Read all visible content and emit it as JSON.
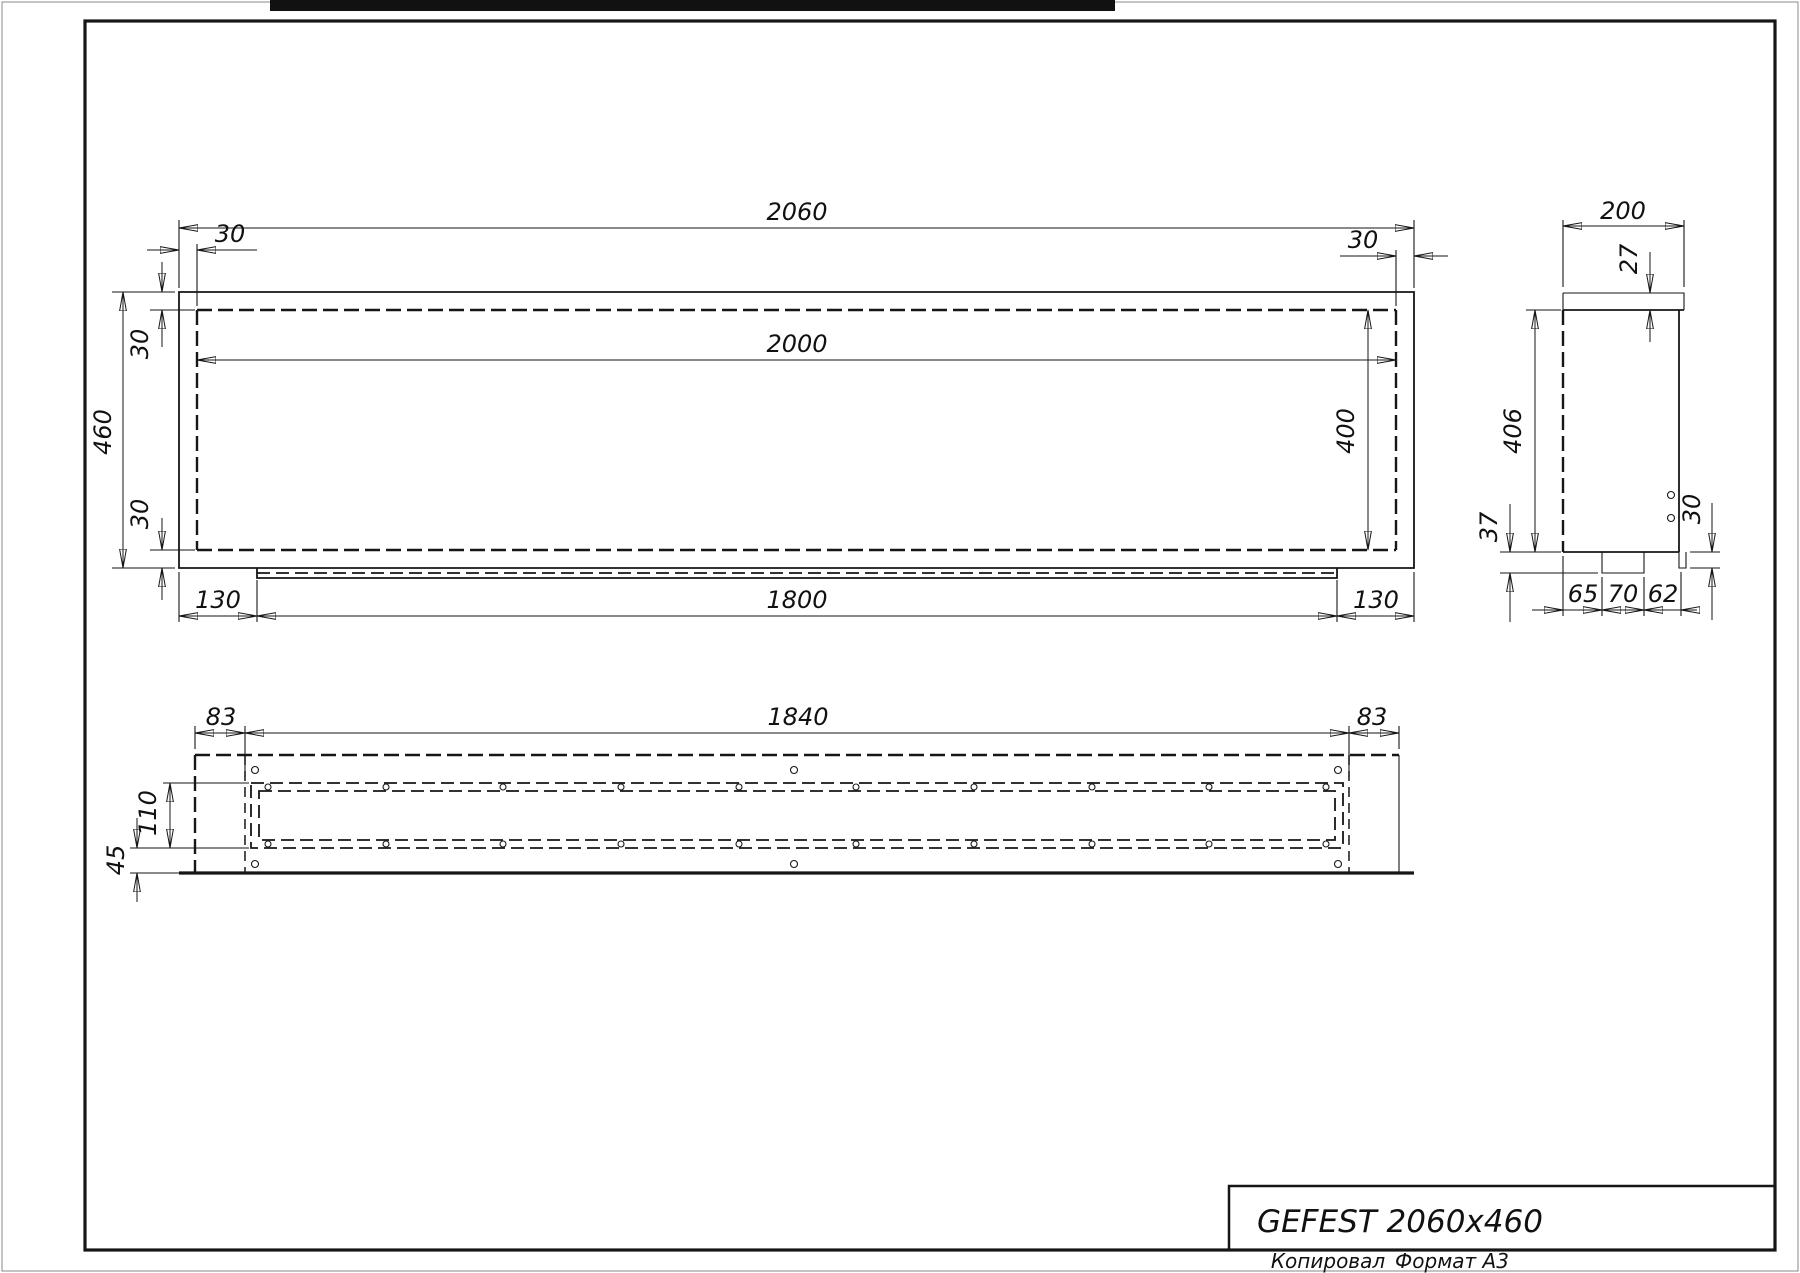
{
  "colors": {
    "ink": "#161616",
    "paper": "#ffffff"
  },
  "front_view": {
    "dims": {
      "total_width": "2060",
      "inner_width": "2000",
      "total_height": "460",
      "top_offset_left": "30",
      "top_offset_right": "30",
      "wall_top": "30",
      "wall_bottom": "30",
      "inner_height": "400",
      "base_offset_left": "130",
      "base_width": "1800",
      "base_offset_right": "130"
    }
  },
  "side_view": {
    "dims": {
      "depth": "200",
      "rim_thickness": "27",
      "body_height": "406",
      "foot_drop": "37",
      "step_height": "30",
      "seg_a": "65",
      "seg_b": "70",
      "seg_c": "62"
    }
  },
  "bottom_view": {
    "dims": {
      "edge_left": "83",
      "opening_length": "1840",
      "edge_right": "83",
      "slot_width": "110",
      "flange_offset": "45"
    }
  },
  "title_block": {
    "model": "GEFEST 2060x460"
  },
  "footer": {
    "copied": "Копировал",
    "format": "Формат А3"
  }
}
